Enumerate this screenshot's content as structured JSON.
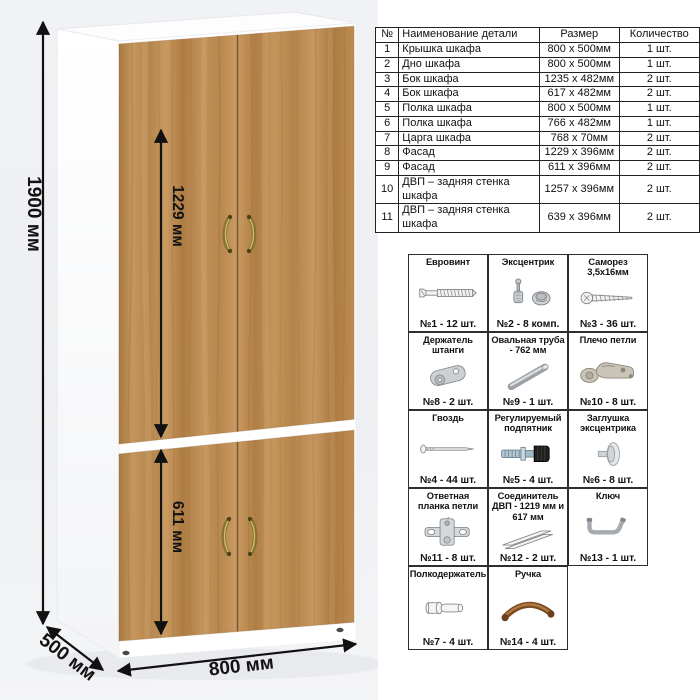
{
  "illustration": {
    "dimensions": {
      "height": "1900 мм",
      "width": "800 мм",
      "depth": "500 мм",
      "upper_facade_height": "1229 мм",
      "lower_facade_height": "611 мм"
    },
    "colors": {
      "wood": "#bf8c55",
      "carcass": "#ffffff",
      "handle": "#8a742c",
      "backdrop": "#eff1f4"
    }
  },
  "parts_table": {
    "headers": [
      "№",
      "Наименование детали",
      "Размер",
      "Количество"
    ],
    "rows": [
      [
        "1",
        "Крышка шкафа",
        "800 x 500мм",
        "1 шт."
      ],
      [
        "2",
        "Дно шкафа",
        "800 x 500мм",
        "1 шт."
      ],
      [
        "3",
        "Бок шкафа",
        "1235 x 482мм",
        "2 шт."
      ],
      [
        "4",
        "Бок шкафа",
        "617 x 482мм",
        "2 шт."
      ],
      [
        "5",
        "Полка шкафа",
        "800 x 500мм",
        "1 шт."
      ],
      [
        "6",
        "Полка шкафа",
        "766 x 482мм",
        "1 шт."
      ],
      [
        "7",
        "Царга шкафа",
        "768 x 70мм",
        "2 шт."
      ],
      [
        "8",
        "Фасад",
        "1229 x 396мм",
        "2 шт."
      ],
      [
        "9",
        "Фасад",
        "611 x 396мм",
        "2 шт."
      ],
      [
        "10",
        "ДВП – задняя стенка шкафа",
        "1257 x 396мм",
        "2 шт."
      ],
      [
        "11",
        "ДВП – задняя стенка шкафа",
        "639 x 396мм",
        "2 шт."
      ]
    ]
  },
  "hardware_grid": {
    "items": [
      {
        "name": "Евровинт",
        "count": "№1 - 12 шт.",
        "icon": "euro-screw"
      },
      {
        "name": "Эксцентрик",
        "count": "№2 - 8 комп.",
        "icon": "cam-lock"
      },
      {
        "name": "Саморез 3,5х16мм",
        "count": "№3 - 36 шт.",
        "icon": "self-tapping-screw"
      },
      {
        "name": "Держатель штанги",
        "count": "№8 - 2 шт.",
        "icon": "rod-holder"
      },
      {
        "name": "Овальная труба - 762 мм",
        "count": "№9 - 1 шт.",
        "icon": "oval-tube"
      },
      {
        "name": "Плечо петли",
        "count": "№10 - 8 шт.",
        "icon": "hinge-arm"
      },
      {
        "name": "Гвоздь",
        "count": "№4 - 44 шт.",
        "icon": "nail"
      },
      {
        "name": "Регулируемый подпятник",
        "count": "№5 - 4 шт.",
        "icon": "adjustable-foot"
      },
      {
        "name": "Заглушка эксцентрика",
        "count": "№6 - 8 шт.",
        "icon": "cam-cover"
      },
      {
        "name": "Ответная планка петли",
        "count": "№11 - 8 шт.",
        "icon": "hinge-plate"
      },
      {
        "name": "Соединитель ДВП - 1219 мм и 617 мм",
        "count": "№12 - 2 шт.",
        "icon": "hdf-connector"
      },
      {
        "name": "Ключ",
        "count": "№13 - 1 шт.",
        "icon": "hex-key"
      },
      {
        "name": "Полкодержатель",
        "count": "№7 - 4 шт.",
        "icon": "shelf-pin"
      },
      {
        "name": "Ручка",
        "count": "№14 - 4 шт.",
        "icon": "handle"
      }
    ]
  }
}
